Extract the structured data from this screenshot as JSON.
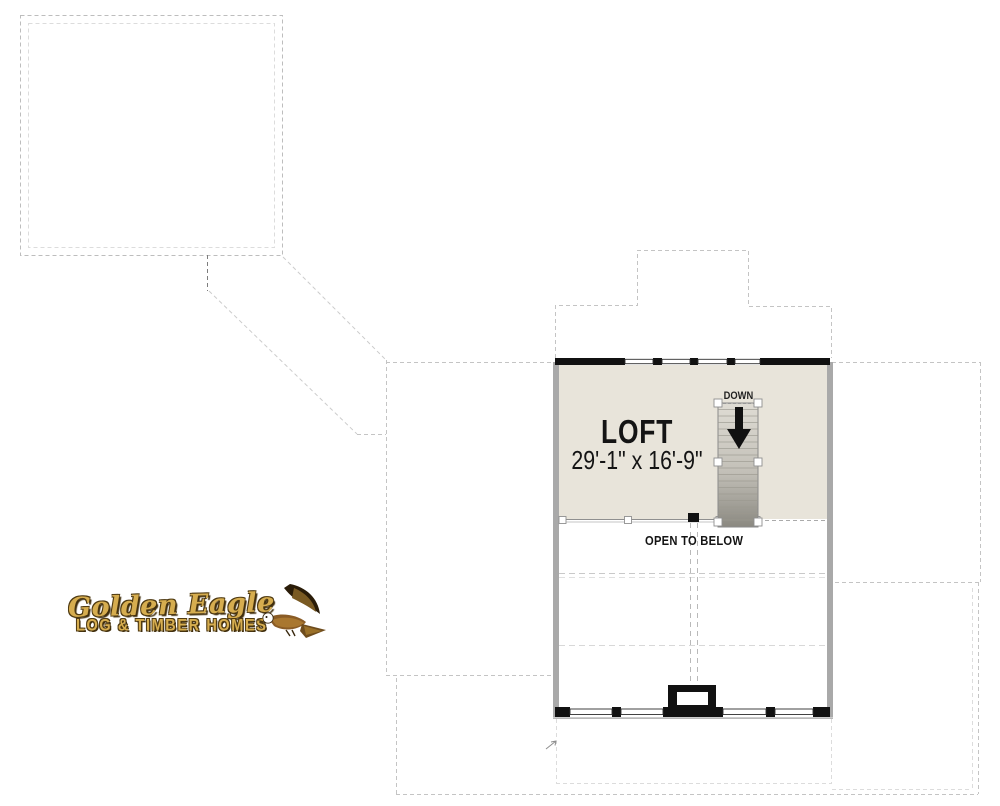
{
  "plan": {
    "room": {
      "label": "LOFT",
      "dimensions": "29'-1\" x 16'-9\""
    },
    "stair": {
      "label": "DOWN",
      "icon": "down-arrow-icon"
    },
    "open_to_below_label": "OPEN TO BELOW"
  },
  "logo": {
    "title": "Golden Eagle",
    "subtitle": "LOG & TIMBER HOMES",
    "icon": "eagle-icon",
    "gold_color": "#d6ad4f"
  },
  "colors": {
    "floor_fill": "#e8e4da",
    "wall_black": "#111111",
    "wall_gray": "#a9a9a9",
    "dashed_roof_line": "#c4c4c4",
    "stair_dark": "#8b8981",
    "background": "#ffffff"
  }
}
